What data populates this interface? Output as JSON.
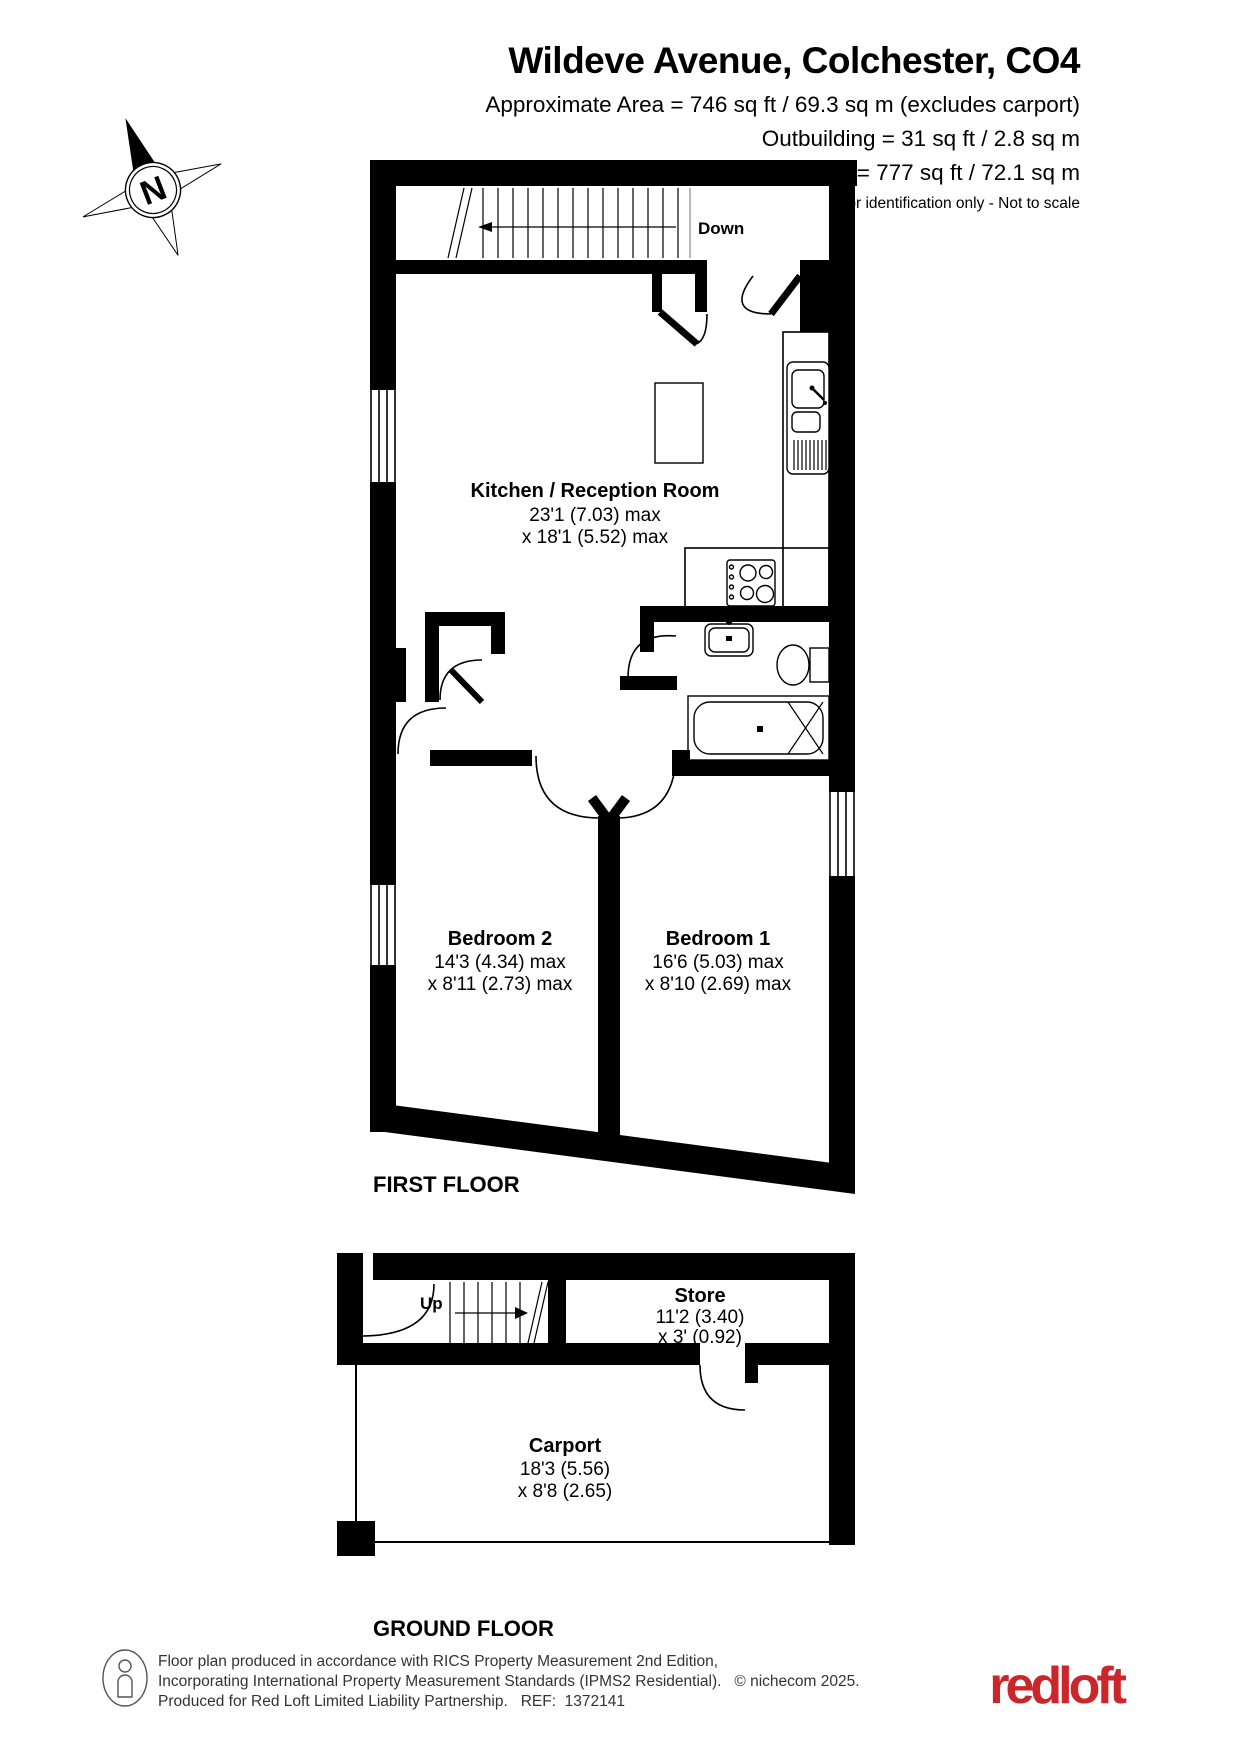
{
  "header": {
    "title": "Wildeve Avenue, Colchester, CO4",
    "area_line1": "Approximate Area = 746 sq ft / 69.3 sq m (excludes carport)",
    "area_line2": "Outbuilding = 31 sq ft / 2.8 sq m",
    "area_line3": "Total = 777 sq ft / 72.1 sq m",
    "disclaimer": "For identification only - Not to scale"
  },
  "compass": {
    "label": "N"
  },
  "first_floor": {
    "floor_label": "FIRST FLOOR",
    "stairs_label": "Down",
    "rooms": {
      "kitchen": {
        "name": "Kitchen / Reception Room",
        "dim1": "23'1 (7.03) max",
        "dim2": "x 18'1 (5.52) max"
      },
      "bedroom2": {
        "name": "Bedroom 2",
        "dim1": "14'3 (4.34) max",
        "dim2": "x 8'11 (2.73) max"
      },
      "bedroom1": {
        "name": "Bedroom 1",
        "dim1": "16'6 (5.03) max",
        "dim2": "x 8'10 (2.69) max"
      }
    }
  },
  "ground_floor": {
    "floor_label": "GROUND FLOOR",
    "stairs_label": "Up",
    "rooms": {
      "store": {
        "name": "Store",
        "dim1": "11'2 (3.40)",
        "dim2": "x 3' (0.92)"
      },
      "carport": {
        "name": "Carport",
        "dim1": "18'3 (5.56)",
        "dim2": "x 8'8 (2.65)"
      }
    }
  },
  "footer": {
    "line1": "Floor plan produced in accordance with RICS Property Measurement 2nd Edition,",
    "line2": "Incorporating International Property Measurement Standards (IPMS2 Residential).   © nichecom 2025.",
    "line3": "Produced for Red Loft Limited Liability Partnership.   REF:  1372141",
    "logo_text": "redloft"
  },
  "colors": {
    "walls": "#000000",
    "logo_red": "#cb262c",
    "stair_edge": "#9a9a9a",
    "footer_text": "#333333"
  }
}
